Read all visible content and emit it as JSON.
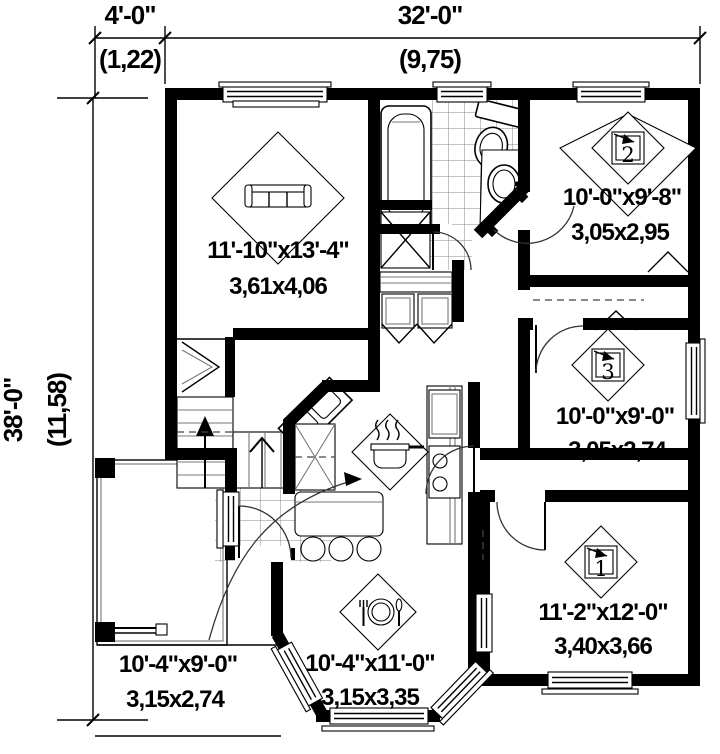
{
  "drawing": {
    "dims": {
      "offset": {
        "ft": "4'-0\"",
        "m": "(1,22)"
      },
      "width": {
        "ft": "32'-0\"",
        "m": "(9,75)"
      },
      "height": {
        "ft": "38'-0\"",
        "m": "(11,58)"
      }
    },
    "rooms": {
      "living": {
        "ft": "11'-10\"x13'-4\"",
        "m": "3,61x4,06"
      },
      "bedroom2": {
        "ft": "10'-0\"x9'-8\"",
        "m": "3,05x2,95",
        "tag": "2"
      },
      "bedroom3": {
        "ft": "10'-0\"x9'-0\"",
        "m": "3,05x2,74",
        "tag": "3"
      },
      "bedroom1": {
        "ft": "11'-2\"x12'-0\"",
        "m": "3,40x3,66",
        "tag": "1"
      },
      "kitchen": {
        "ft": "10'-4\"x9'-0\"",
        "m": "3,15x2,74"
      },
      "dining": {
        "ft": "10'-4\"x11'-0\"",
        "m": "3,15x3,35"
      }
    },
    "colors": {
      "wall": "#000000",
      "line": "#2a2a2a",
      "tile": "#999999",
      "bg": "#ffffff"
    }
  }
}
